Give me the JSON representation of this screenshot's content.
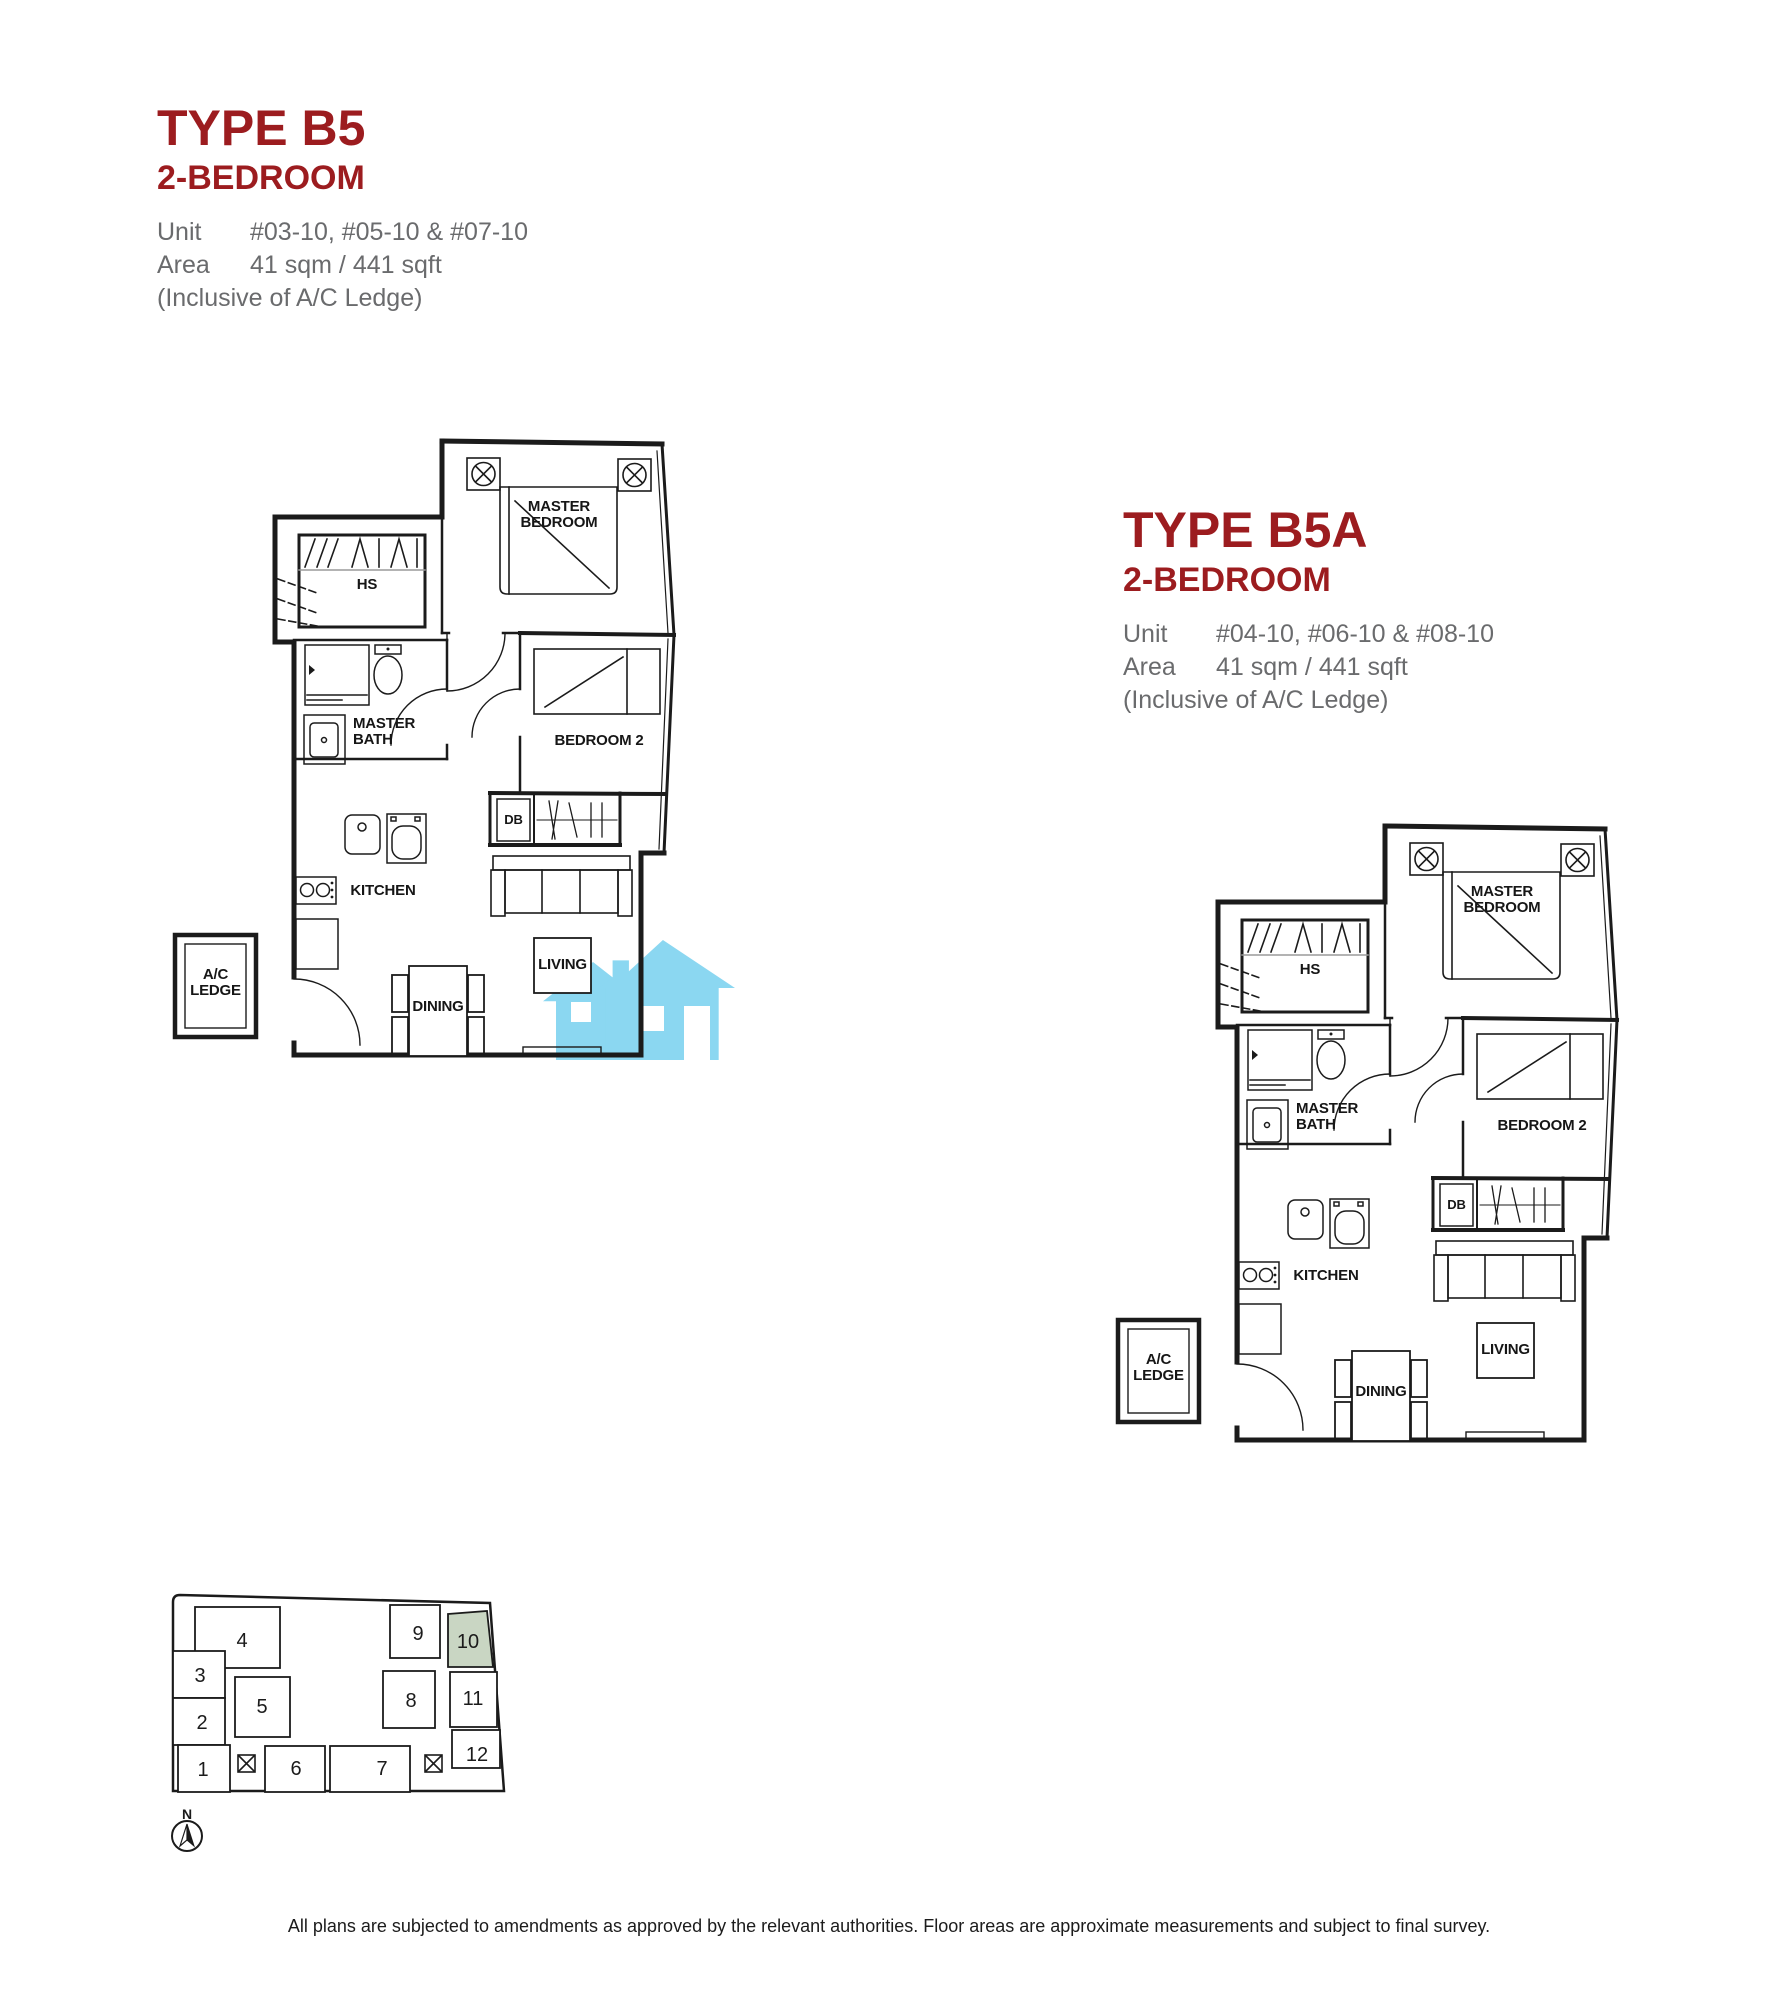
{
  "colors": {
    "accent_red": "#9c1c1f",
    "gray_text": "#6a6b6d",
    "line_black": "#1b1b1b",
    "highlight_green": "#c9d6c3",
    "watermark_blue": "#8bd7f1"
  },
  "header_b5": {
    "title": "TYPE B5",
    "subtitle": "2-BEDROOM",
    "unit_label": "Unit",
    "unit_value": "#03-10, #05-10 & #07-10",
    "area_label": "Area",
    "area_value": "41 sqm / 441 sqft",
    "note": "(Inclusive of A/C Ledge)"
  },
  "header_b5a": {
    "title": "TYPE B5A",
    "subtitle": "2-BEDROOM",
    "unit_label": "Unit",
    "unit_value": "#04-10, #06-10 & #08-10",
    "area_label": "Area",
    "area_value": "41 sqm / 441 sqft",
    "note": "(Inclusive of A/C Ledge)"
  },
  "plan_labels": {
    "master_bedroom_1": "MASTER",
    "master_bedroom_2": "BEDROOM",
    "hs": "HS",
    "master_bath_1": "MASTER",
    "master_bath_2": "BATH",
    "bedroom2": "BEDROOM 2",
    "db": "DB",
    "kitchen": "KITCHEN",
    "dining": "DINING",
    "living": "LIVING",
    "ac_1": "A/C",
    "ac_2": "LEDGE"
  },
  "site_plan": {
    "unit_numbers": [
      "1",
      "2",
      "3",
      "4",
      "5",
      "6",
      "7",
      "8",
      "9",
      "10",
      "11",
      "12"
    ],
    "highlighted_unit": "10",
    "north_label": "N"
  },
  "footer": {
    "disclaimer": "All plans are subjected to amendments as approved by the relevant authorities. Floor areas are approximate measurements and subject to final survey."
  }
}
